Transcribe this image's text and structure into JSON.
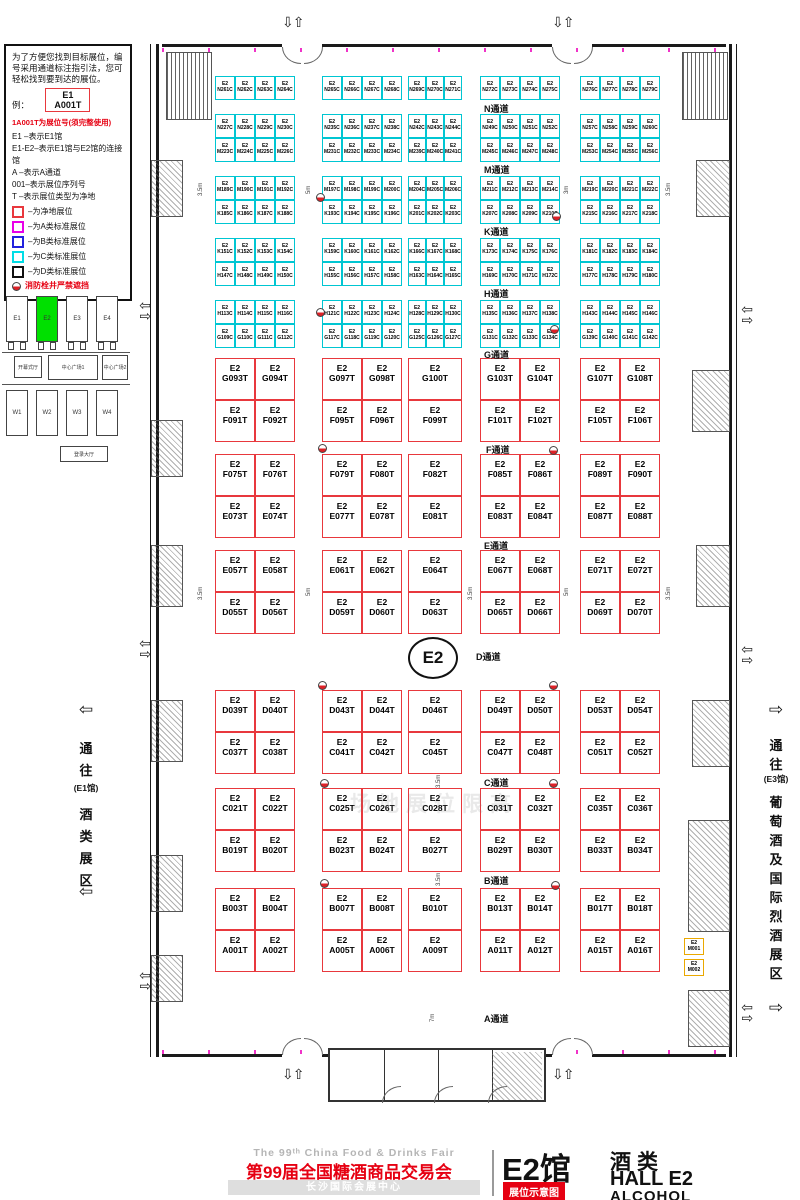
{
  "legend": {
    "intro": "为了方便您找到目标展位，编号采用通道标注指引法，您可轻松找到要到达的展位。",
    "example_label": "例：",
    "sample_line1": "E1",
    "sample_line2": "A001T",
    "red_note": "1A001T为展位号(须完整使用)",
    "lines": [
      "E1 –表示E1馆",
      "E1-E2–表示E1馆与E2馆的连接馆",
      "A  –表示A通道",
      "001–表示展位序列号",
      "T  –表示展位类型为净地"
    ],
    "swatches": [
      {
        "color": "#e8383d",
        "label": "–为净地展位"
      },
      {
        "color": "#e800e8",
        "label": "–为A类标准展位"
      },
      {
        "color": "#2222dd",
        "label": "–为B类标准展位"
      },
      {
        "color": "#00dde6",
        "label": "–为C类标准展位"
      },
      {
        "color": "#111111",
        "label": "–为D类标准展位"
      }
    ],
    "hydrant_note": "消防栓井严禁遮挡"
  },
  "minimap": {
    "east_halls": [
      "E1",
      "E2",
      "E3",
      "E4"
    ],
    "highlight": "E2",
    "highlight_color": "#00e000",
    "center_left": "开幕式厅",
    "plaza1": "中心广场1",
    "plaza2": "中心广场2",
    "west_halls": [
      "W1",
      "W2",
      "W3",
      "W4"
    ],
    "bottom": "登录大厅"
  },
  "side_labels": {
    "left": {
      "arrow": "⇦",
      "chars": [
        "通",
        "往",
        "(E1馆)",
        "酒",
        "类",
        "展",
        "区"
      ]
    },
    "right": {
      "arrow": "⇨",
      "chars": [
        "通",
        "往",
        "(E3馆)",
        "葡",
        "萄",
        "酒",
        "及",
        "国",
        "际",
        "烈",
        "酒",
        "展",
        "区"
      ]
    }
  },
  "hall": {
    "prefix": "E2",
    "center_label": "E2",
    "watermark": "场地展位限高",
    "aisles": [
      {
        "label": "N通道",
        "x": 484,
        "y": 102
      },
      {
        "label": "M通道",
        "x": 484,
        "y": 163
      },
      {
        "label": "K通道",
        "x": 484,
        "y": 225
      },
      {
        "label": "H通道",
        "x": 484,
        "y": 287
      },
      {
        "label": "G通道",
        "x": 484,
        "y": 348
      },
      {
        "label": "F通道",
        "x": 486,
        "y": 443
      },
      {
        "label": "E通道",
        "x": 484,
        "y": 539
      },
      {
        "label": "D通道",
        "x": 476,
        "y": 650
      },
      {
        "label": "C通道",
        "x": 484,
        "y": 776
      },
      {
        "label": "B通道",
        "x": 484,
        "y": 874
      },
      {
        "label": "A通道",
        "x": 484,
        "y": 1012
      }
    ],
    "cyan_bands": [
      [
        [
          [
            "N261C",
            "N262C",
            "N263C",
            "N264C"
          ],
          [
            "N265C",
            "N266C",
            "N267C",
            "N268C"
          ],
          [
            "N269C",
            "N270C",
            "N271C"
          ],
          [
            "N272C",
            "N273C",
            "N274C",
            "N275C"
          ],
          [
            "N276C",
            "N277C",
            "N278C",
            "N279C"
          ]
        ]
      ],
      [
        [
          [
            "N227C",
            "N228C",
            "N229C",
            "N230C"
          ],
          [
            "N235C",
            "N236C",
            "N237C",
            "N238C"
          ],
          [
            "N242C",
            "N243C",
            "N244C"
          ],
          [
            "N249C",
            "N250C",
            "N251C",
            "N252C"
          ],
          [
            "N257C",
            "N258C",
            "N259C",
            "N260C"
          ]
        ],
        [
          [
            "M223C",
            "M224C",
            "M225C",
            "M226C"
          ],
          [
            "M231C",
            "M232C",
            "M233C",
            "M234C"
          ],
          [
            "M239C",
            "M240C",
            "M241C"
          ],
          [
            "M245C",
            "M246C",
            "M247C",
            "M248C"
          ],
          [
            "M253C",
            "M254C",
            "M255C",
            "M256C"
          ]
        ]
      ],
      [
        [
          [
            "M189C",
            "M190C",
            "M191C",
            "M192C"
          ],
          [
            "M197C",
            "M198C",
            "M199C",
            "M200C"
          ],
          [
            "M204C",
            "M205C",
            "M206C"
          ],
          [
            "M211C",
            "M212C",
            "M213C",
            "M214C"
          ],
          [
            "M219C",
            "M220C",
            "M221C",
            "M222C"
          ]
        ],
        [
          [
            "K185C",
            "K186C",
            "K187C",
            "K188C"
          ],
          [
            "K193C",
            "K194C",
            "K195C",
            "K196C"
          ],
          [
            "K201C",
            "K202C",
            "K203C"
          ],
          [
            "K207C",
            "K208C",
            "K209C",
            "K210C"
          ],
          [
            "K215C",
            "K216C",
            "K217C",
            "K218C"
          ]
        ]
      ],
      [
        [
          [
            "K151C",
            "K152C",
            "K153C",
            "K154C"
          ],
          [
            "K159C",
            "K160C",
            "K161C",
            "K162C"
          ],
          [
            "K166C",
            "K167C",
            "K168C"
          ],
          [
            "K173C",
            "K174C",
            "K175C",
            "K176C"
          ],
          [
            "K181C",
            "K182C",
            "K183C",
            "K184C"
          ]
        ],
        [
          [
            "H147C",
            "H148C",
            "H149C",
            "H150C"
          ],
          [
            "H155C",
            "H156C",
            "H157C",
            "H158C"
          ],
          [
            "H163C",
            "H164C",
            "H165C"
          ],
          [
            "H169C",
            "H170C",
            "H171C",
            "H172C"
          ],
          [
            "H177C",
            "H178C",
            "H179C",
            "H180C"
          ]
        ]
      ],
      [
        [
          [
            "H113C",
            "H114C",
            "H115C",
            "H116C"
          ],
          [
            "H121C",
            "H122C",
            "H123C",
            "H124C"
          ],
          [
            "H128C",
            "H129C",
            "H130C"
          ],
          [
            "H135C",
            "H136C",
            "H137C",
            "H138C"
          ],
          [
            "H143C",
            "H144C",
            "H145C",
            "H146C"
          ]
        ],
        [
          [
            "G109C",
            "G110C",
            "G111C",
            "G112C"
          ],
          [
            "G117C",
            "G118C",
            "G119C",
            "G120C"
          ],
          [
            "G125C",
            "G126C",
            "G127C"
          ],
          [
            "G131C",
            "G132C",
            "G133C",
            "G134C"
          ],
          [
            "G139C",
            "G140C",
            "G141C",
            "G142C"
          ]
        ]
      ]
    ],
    "red_bands": [
      [
        [
          [
            "G093T",
            "G094T"
          ],
          [
            "G097T",
            "G098T"
          ],
          [
            "G100T"
          ],
          [
            "G103T",
            "G104T"
          ],
          [
            "G107T",
            "G108T"
          ]
        ],
        [
          [
            "F091T",
            "F092T"
          ],
          [
            "F095T",
            "F096T"
          ],
          [
            "F099T"
          ],
          [
            "F101T",
            "F102T"
          ],
          [
            "F105T",
            "F106T"
          ]
        ]
      ],
      [
        [
          [
            "F075T",
            "F076T"
          ],
          [
            "F079T",
            "F080T"
          ],
          [
            "F082T"
          ],
          [
            "F085T",
            "F086T"
          ],
          [
            "F089T",
            "F090T"
          ]
        ],
        [
          [
            "E073T",
            "E074T"
          ],
          [
            "E077T",
            "E078T"
          ],
          [
            "E081T"
          ],
          [
            "E083T",
            "E084T"
          ],
          [
            "E087T",
            "E088T"
          ]
        ]
      ],
      [
        [
          [
            "E057T",
            "E058T"
          ],
          [
            "E061T",
            "E062T"
          ],
          [
            "E064T"
          ],
          [
            "E067T",
            "E068T"
          ],
          [
            "E071T",
            "E072T"
          ]
        ],
        [
          [
            "D055T",
            "D056T"
          ],
          [
            "D059T",
            "D060T"
          ],
          [
            "D063T"
          ],
          [
            "D065T",
            "D066T"
          ],
          [
            "D069T",
            "D070T"
          ]
        ]
      ],
      [
        [
          [
            "D039T",
            "D040T"
          ],
          [
            "D043T",
            "D044T"
          ],
          [
            "D046T"
          ],
          [
            "D049T",
            "D050T"
          ],
          [
            "D053T",
            "D054T"
          ]
        ],
        [
          [
            "C037T",
            "C038T"
          ],
          [
            "C041T",
            "C042T"
          ],
          [
            "C045T"
          ],
          [
            "C047T",
            "C048T"
          ],
          [
            "C051T",
            "C052T"
          ]
        ]
      ],
      [
        [
          [
            "C021T",
            "C022T"
          ],
          [
            "C025T",
            "C026T"
          ],
          [
            "C028T"
          ],
          [
            "C031T",
            "C032T"
          ],
          [
            "C035T",
            "C036T"
          ]
        ],
        [
          [
            "B019T",
            "B020T"
          ],
          [
            "B023T",
            "B024T"
          ],
          [
            "B027T"
          ],
          [
            "B029T",
            "B030T"
          ],
          [
            "B033T",
            "B034T"
          ]
        ]
      ],
      [
        [
          [
            "B003T",
            "B004T"
          ],
          [
            "B007T",
            "B008T"
          ],
          [
            "B010T"
          ],
          [
            "B013T",
            "B014T"
          ],
          [
            "B017T",
            "B018T"
          ]
        ],
        [
          [
            "A001T",
            "A002T"
          ],
          [
            "A005T",
            "A006T"
          ],
          [
            "A009T"
          ],
          [
            "A011T",
            "A012T"
          ],
          [
            "A015T",
            "A016T"
          ]
        ]
      ]
    ],
    "special_booths": [
      {
        "code": "M001",
        "x": 684,
        "y": 938
      },
      {
        "code": "M002",
        "x": 684,
        "y": 959
      }
    ],
    "dims": [
      {
        "t": "3.5m",
        "x": 198,
        "y": 196
      },
      {
        "t": "5m",
        "x": 306,
        "y": 194
      },
      {
        "t": "3m",
        "x": 564,
        "y": 194
      },
      {
        "t": "3.5m",
        "x": 666,
        "y": 196
      },
      {
        "t": "3.5m",
        "x": 198,
        "y": 600
      },
      {
        "t": "5m",
        "x": 306,
        "y": 596
      },
      {
        "t": "3.5m",
        "x": 468,
        "y": 600
      },
      {
        "t": "5m",
        "x": 564,
        "y": 596
      },
      {
        "t": "3.5m",
        "x": 666,
        "y": 600
      },
      {
        "t": "3.5m",
        "x": 436,
        "y": 788
      },
      {
        "t": "3.5m",
        "x": 436,
        "y": 886
      },
      {
        "t": "7m",
        "x": 430,
        "y": 1022
      }
    ],
    "hydrants": [
      {
        "x": 316,
        "y": 193
      },
      {
        "x": 552,
        "y": 212
      },
      {
        "x": 316,
        "y": 308
      },
      {
        "x": 550,
        "y": 325
      },
      {
        "x": 318,
        "y": 444
      },
      {
        "x": 549,
        "y": 446
      },
      {
        "x": 318,
        "y": 681
      },
      {
        "x": 549,
        "y": 681
      },
      {
        "x": 320,
        "y": 779
      },
      {
        "x": 549,
        "y": 779
      },
      {
        "x": 320,
        "y": 879
      },
      {
        "x": 551,
        "y": 881
      }
    ]
  },
  "footer": {
    "en_title": "The 99ᵗʰ China Food & Drinks Fair",
    "cn_title": "第99届全国糖酒商品交易会",
    "venue": "长沙国际会展中心",
    "hall_big": "E2馆",
    "badge": "展位示意图",
    "cat_cn": "酒类",
    "hall_en": "HALL E2",
    "cat_en": "ALCOHOL"
  }
}
